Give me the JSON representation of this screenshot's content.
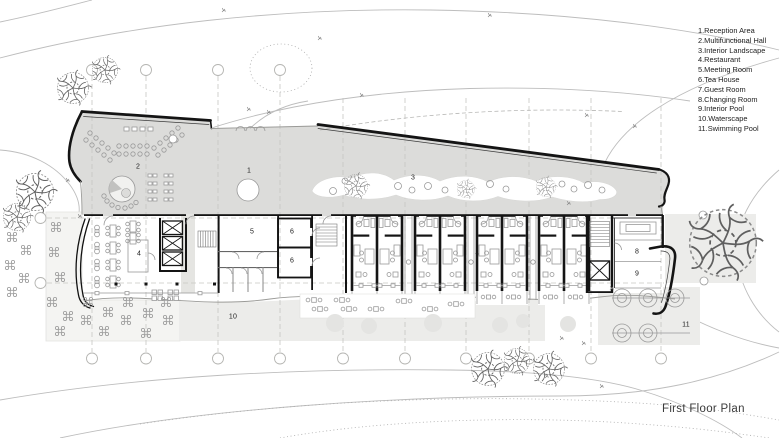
{
  "title": "First Floor Plan",
  "legend": {
    "items": [
      "1.Reception Area",
      "2.Multifunctional Hall",
      "3.Interior Landscape",
      "4.Restaurant",
      "5.Meeting Room",
      "6.Tea House",
      "7.Guest Room",
      "8.Changing Room",
      "9.Interior Pool",
      "10.Waterscape",
      "11.Swimming Pool"
    ]
  },
  "rooms": [
    "1",
    "2",
    "3",
    "4",
    "5",
    "6",
    "6",
    "7",
    "8",
    "9",
    "10",
    "11"
  ],
  "colors": {
    "wall": "#141414",
    "building_fill": "#dcdcda",
    "room_fill": "#ffffff",
    "terrace_fill": "#f4f4f2",
    "water_fill": "#ececea",
    "contour": "#bdbdbd",
    "furniture": "#9a9a9a",
    "grid": "#c6c6c3",
    "text": "#1c1c1c"
  }
}
